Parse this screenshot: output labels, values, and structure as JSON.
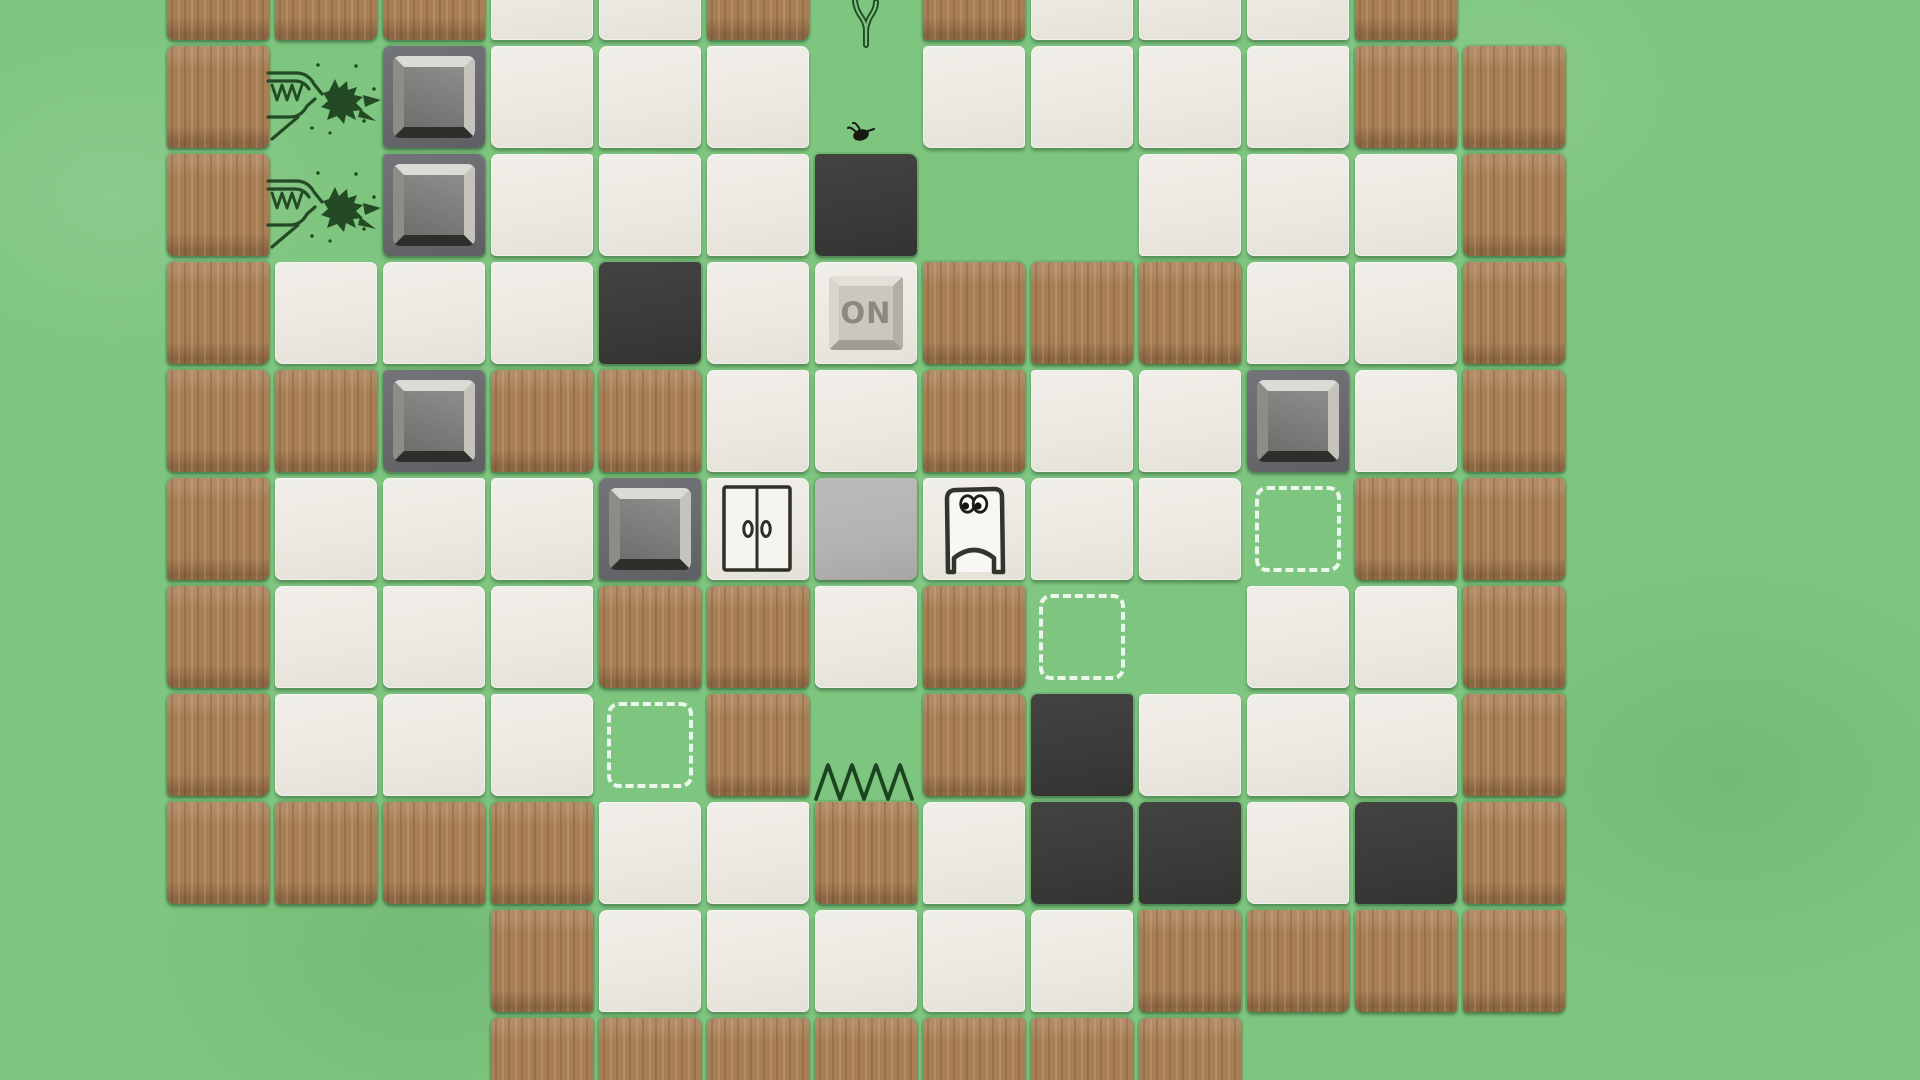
{
  "game": {
    "button_label": "ON",
    "grid": {
      "cols": 13,
      "rows": 11,
      "cell_size": 108,
      "origin_x": 164,
      "origin_y": -65,
      "legend": {
        ".": "grass-empty",
        "B": "wood-wall-tile",
        "W": "white-floor-tile",
        "K": "dark-floor-tile",
        "S": "stone-block-on-gray-pad",
        "D": "dashed-target-marker",
        "F": "flat-gray-slab-tile",
        "O": "on-button-tile",
        "R": "double-door-tile"
      },
      "tiles": [
        "BBBWWB.BWWWB.",
        "B.SWWW.WWWWBB",
        "B.SWWWK..WWWB",
        "BWWWKWOBBBWWB",
        "BBSBBWWBWWSWB",
        "BWWWSRFWWWDBB",
        "BWWWBBWBD.WWB",
        "BWWWDB.BKWWWB",
        "BBBBWWBWKKWKB",
        "...BWWWWWBBBB",
        "...BBBBBBB..."
      ]
    },
    "objects": [
      {
        "type": "sapling",
        "row": 0,
        "col": 6
      },
      {
        "type": "flame-creature",
        "row": 1,
        "col": 1,
        "facing": "right"
      },
      {
        "type": "flame-creature",
        "row": 2,
        "col": 1,
        "facing": "right"
      },
      {
        "type": "fly",
        "row": 1,
        "col": 6
      },
      {
        "type": "player",
        "row": 5,
        "col": 7
      },
      {
        "type": "spikes",
        "row": 7,
        "col": 6
      }
    ],
    "colors": {
      "grass": "#7ec57f",
      "wood_tile": "#a87f55",
      "floor_tile": "#eceae3",
      "dark_tile": "#3b3b39",
      "stone_pad": "#686a6d",
      "stone_block": "#7f7f7d",
      "gray_slab": "#b4b3b1",
      "button_face": "#cbc7bf",
      "button_text": "#8b887e",
      "target_dash": "#f3fbf2",
      "ink_outline": "#2e2f28",
      "ink_green": "#234a24"
    }
  }
}
